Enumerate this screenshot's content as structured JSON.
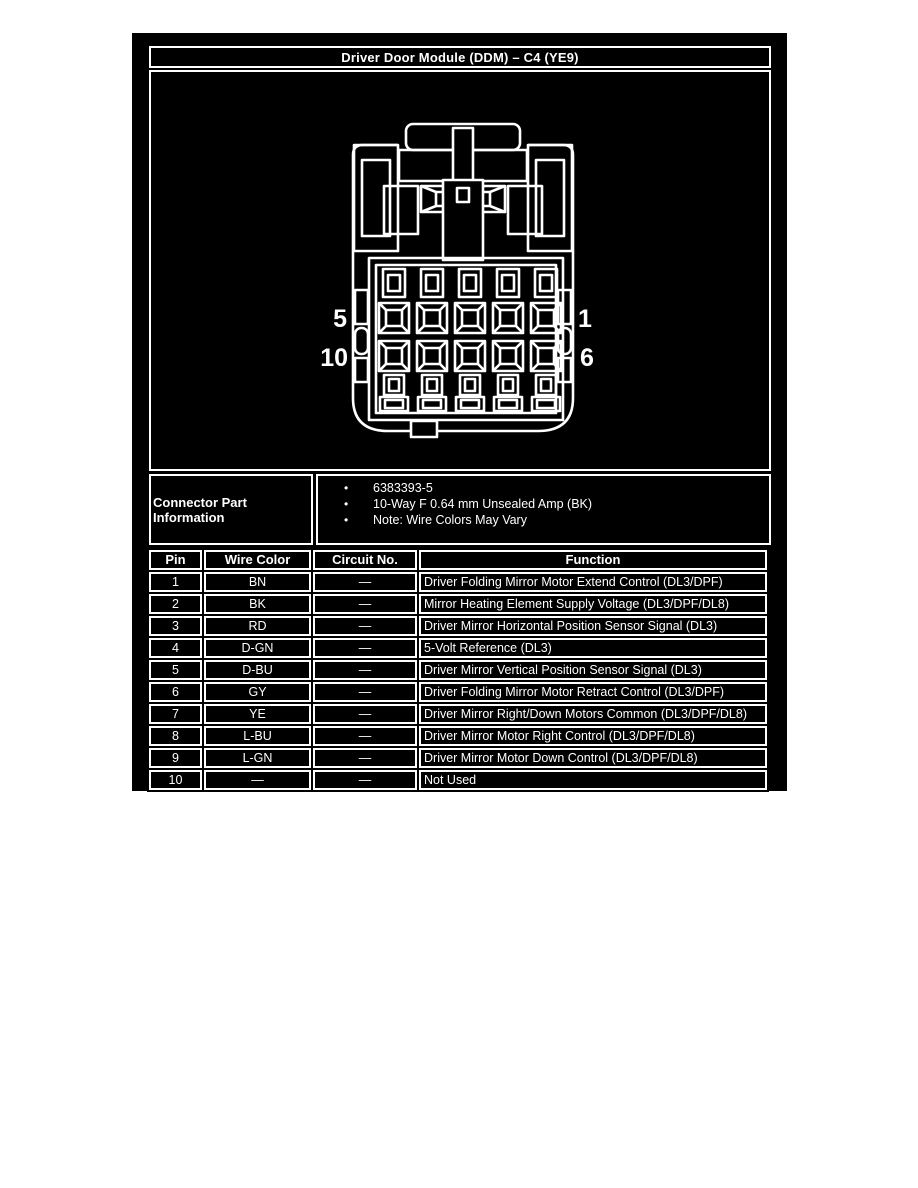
{
  "title": "Driver Door Module (DDM) – C4 (YE9)",
  "colors": {
    "page_bg": "#ffffff",
    "panel_bg": "#000000",
    "line_and_text": "#ffffff"
  },
  "diagram": {
    "description": "10-way connector face view line drawing",
    "pin_labels": {
      "left_top": "5",
      "left_bottom": "10",
      "right_top": "1",
      "right_bottom": "6"
    }
  },
  "connector_part_information": {
    "label": "Connector Part Information",
    "bullets": [
      "6383393-5",
      "10-Way F 0.64 mm Unsealed Amp (BK)",
      "Note: Wire Colors May Vary"
    ]
  },
  "pin_table": {
    "headers": [
      "Pin",
      "Wire Color",
      "Circuit No.",
      "Function"
    ],
    "rows": [
      [
        "1",
        "BN",
        "—",
        "Driver Folding Mirror Motor Extend Control (DL3/DPF)"
      ],
      [
        "2",
        "BK",
        "—",
        "Mirror Heating Element Supply Voltage (DL3/DPF/DL8)"
      ],
      [
        "3",
        "RD",
        "—",
        "Driver Mirror Horizontal Position Sensor Signal (DL3)"
      ],
      [
        "4",
        "D-GN",
        "—",
        "5-Volt Reference (DL3)"
      ],
      [
        "5",
        "D-BU",
        "—",
        "Driver Mirror Vertical Position Sensor Signal (DL3)"
      ],
      [
        "6",
        "GY",
        "—",
        "Driver Folding Mirror Motor Retract Control (DL3/DPF)"
      ],
      [
        "7",
        "YE",
        "—",
        "Driver Mirror Right/Down Motors Common (DL3/DPF/DL8)"
      ],
      [
        "8",
        "L-BU",
        "—",
        "Driver Mirror Motor Right Control (DL3/DPF/DL8)"
      ],
      [
        "9",
        "L-GN",
        "—",
        "Driver Mirror Motor Down Control (DL3/DPF/DL8)"
      ],
      [
        "10",
        "—",
        "—",
        "Not Used"
      ]
    ]
  }
}
